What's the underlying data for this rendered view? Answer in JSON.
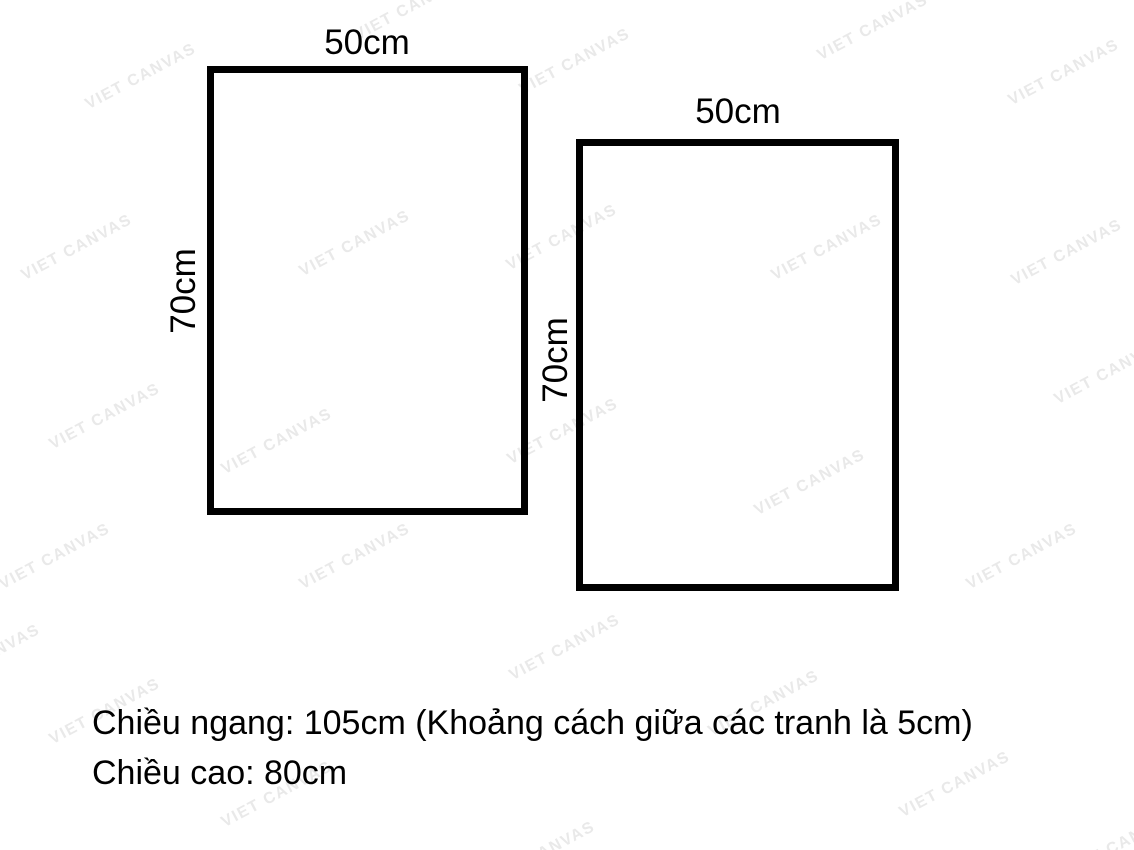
{
  "watermark": {
    "text": "VIET CANVAS",
    "color": "#e9e9e9",
    "rotation_deg": -28,
    "positions": [
      [
        410,
        8
      ],
      [
        873,
        28
      ],
      [
        141,
        77
      ],
      [
        575,
        62
      ],
      [
        1064,
        73
      ],
      [
        77,
        248
      ],
      [
        355,
        244
      ],
      [
        562,
        238
      ],
      [
        827,
        248
      ],
      [
        1067,
        253
      ],
      [
        105,
        417
      ],
      [
        277,
        442
      ],
      [
        563,
        432
      ],
      [
        1110,
        372
      ],
      [
        55,
        557
      ],
      [
        355,
        557
      ],
      [
        810,
        483
      ],
      [
        1022,
        557
      ],
      [
        -15,
        658
      ],
      [
        565,
        648
      ],
      [
        105,
        712
      ],
      [
        764,
        704
      ],
      [
        277,
        795
      ],
      [
        955,
        785
      ],
      [
        540,
        855
      ],
      [
        1120,
        845
      ]
    ]
  },
  "frames": [
    {
      "width_label": "50cm",
      "height_label": "70cm"
    },
    {
      "width_label": "50cm",
      "height_label": "70cm"
    }
  ],
  "notes": {
    "line1": "Chiều ngang: 105cm (Khoảng cách giữa các tranh là 5cm)",
    "line2": "Chiều cao: 80cm"
  }
}
